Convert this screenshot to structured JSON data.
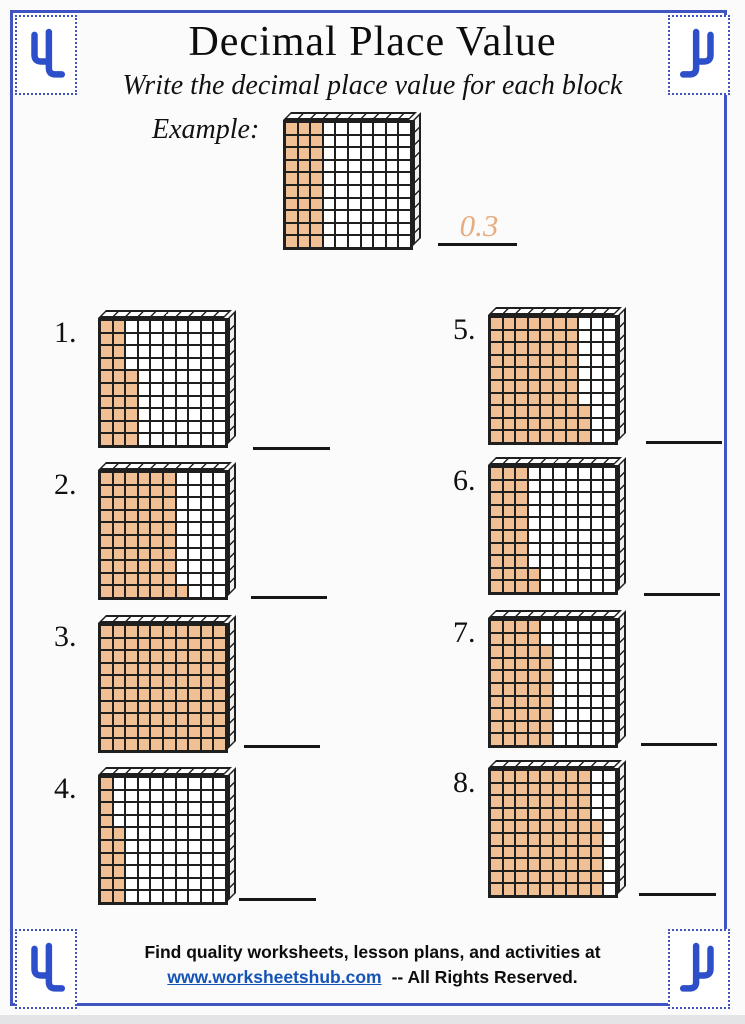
{
  "header": {
    "title": "Decimal Place Value",
    "subtitle": "Write the decimal place value for each block"
  },
  "example": {
    "label": "Example:",
    "answer": "0.3",
    "shaded_cells": 30,
    "shaded_per_column": [
      10,
      10,
      10,
      0,
      0,
      0,
      0,
      0,
      0,
      0
    ]
  },
  "problems": [
    {
      "number": "1.",
      "shaded_cells": 26,
      "shaded_per_column": [
        10,
        10,
        6,
        0,
        0,
        0,
        0,
        0,
        0,
        0
      ]
    },
    {
      "number": "2.",
      "shaded_cells": 61,
      "shaded_per_column": [
        10,
        10,
        10,
        10,
        10,
        10,
        1,
        0,
        0,
        0
      ]
    },
    {
      "number": "3.",
      "shaded_cells": 100,
      "shaded_per_column": [
        10,
        10,
        10,
        10,
        10,
        10,
        10,
        10,
        10,
        10
      ]
    },
    {
      "number": "4.",
      "shaded_cells": 16,
      "shaded_per_column": [
        10,
        6,
        0,
        0,
        0,
        0,
        0,
        0,
        0,
        0
      ]
    },
    {
      "number": "5.",
      "shaded_cells": 73,
      "shaded_per_column": [
        10,
        10,
        10,
        10,
        10,
        10,
        10,
        3,
        0,
        0
      ]
    },
    {
      "number": "6.",
      "shaded_cells": 32,
      "shaded_per_column": [
        10,
        10,
        10,
        2,
        0,
        0,
        0,
        0,
        0,
        0
      ]
    },
    {
      "number": "7.",
      "shaded_cells": 48,
      "shaded_per_column": [
        10,
        10,
        10,
        10,
        8,
        0,
        0,
        0,
        0,
        0
      ]
    },
    {
      "number": "8.",
      "shaded_cells": 86,
      "shaded_per_column": [
        10,
        10,
        10,
        10,
        10,
        10,
        10,
        10,
        6,
        0
      ]
    }
  ],
  "footer": {
    "line1": "Find quality worksheets, lesson plans, and activities at",
    "link": "www.worksheetshub.com",
    "suffix": "-- All Rights Reserved."
  },
  "colors": {
    "shaded_fill": "#f0bf93",
    "grid_line": "#1f1f1f",
    "frame_blue": "#4055c2",
    "answer_orange": "#e7ac80",
    "link_blue": "#1553b5"
  }
}
